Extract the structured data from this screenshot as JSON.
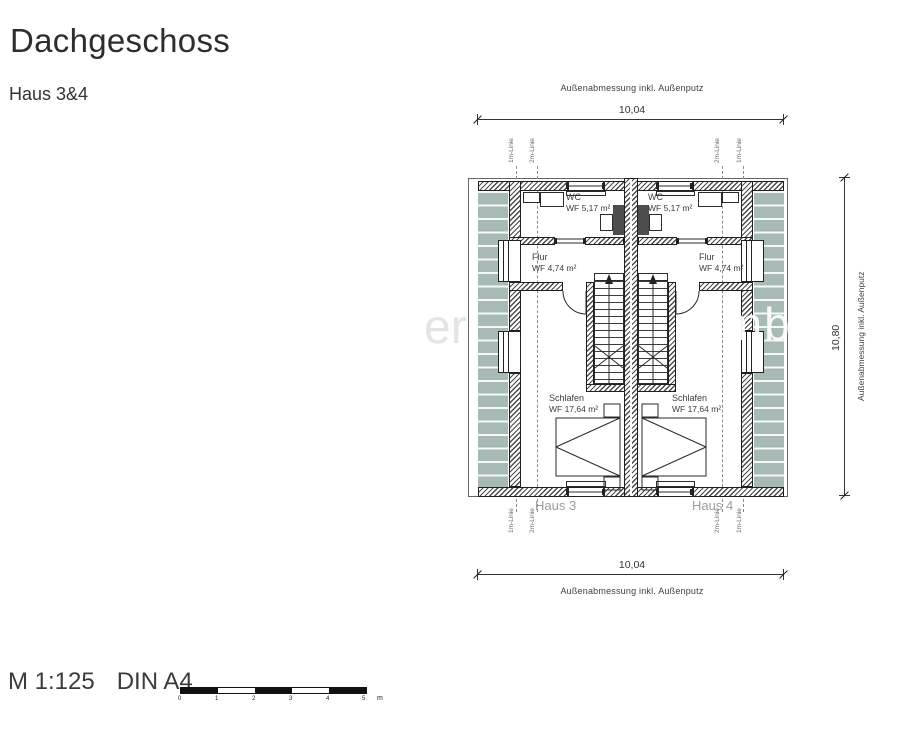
{
  "title": "Dachgeschoss",
  "subtitle": "Haus 3&4",
  "watermark": {
    "left": "er",
    "right": "GmbH"
  },
  "dimensions": {
    "top": {
      "value": "10,04",
      "label": "Außenabmessung inkl. Außenputz"
    },
    "bottom": {
      "value": "10,04",
      "label": "Außenabmessung inkl. Außenputz"
    },
    "right": {
      "value": "10,80",
      "label": "Außenabmessung inkl. Außenputz"
    }
  },
  "plan": {
    "house_left_label": "Haus 3",
    "house_right_label": "Haus 4",
    "height_lines": {
      "one": "1m-Linie",
      "two": "2m-Linie"
    },
    "rooms": {
      "wc_left": {
        "name": "WC",
        "area": "WF 5,17 m²"
      },
      "wc_right": {
        "name": "WC",
        "area": "WF 5,17 m²"
      },
      "flur_left": {
        "name": "Flur",
        "area": "WF 4,74 m²"
      },
      "flur_right": {
        "name": "Flur",
        "area": "WF 4,74 m²"
      },
      "schlafen_left": {
        "name": "Schlafen",
        "area": "WF 17,64 m²"
      },
      "schlafen_right": {
        "name": "Schlafen",
        "area": "WF 17,64 m²"
      }
    }
  },
  "footer": {
    "scale": "M 1:125",
    "format": "DIN A4",
    "scalebar": {
      "ticks": [
        "0",
        "1",
        "2",
        "3",
        "4",
        "5"
      ],
      "unit": "m"
    }
  },
  "colors": {
    "roof_area": "#a8bab6",
    "line": "#333333",
    "muted_label": "#9a9da0"
  }
}
